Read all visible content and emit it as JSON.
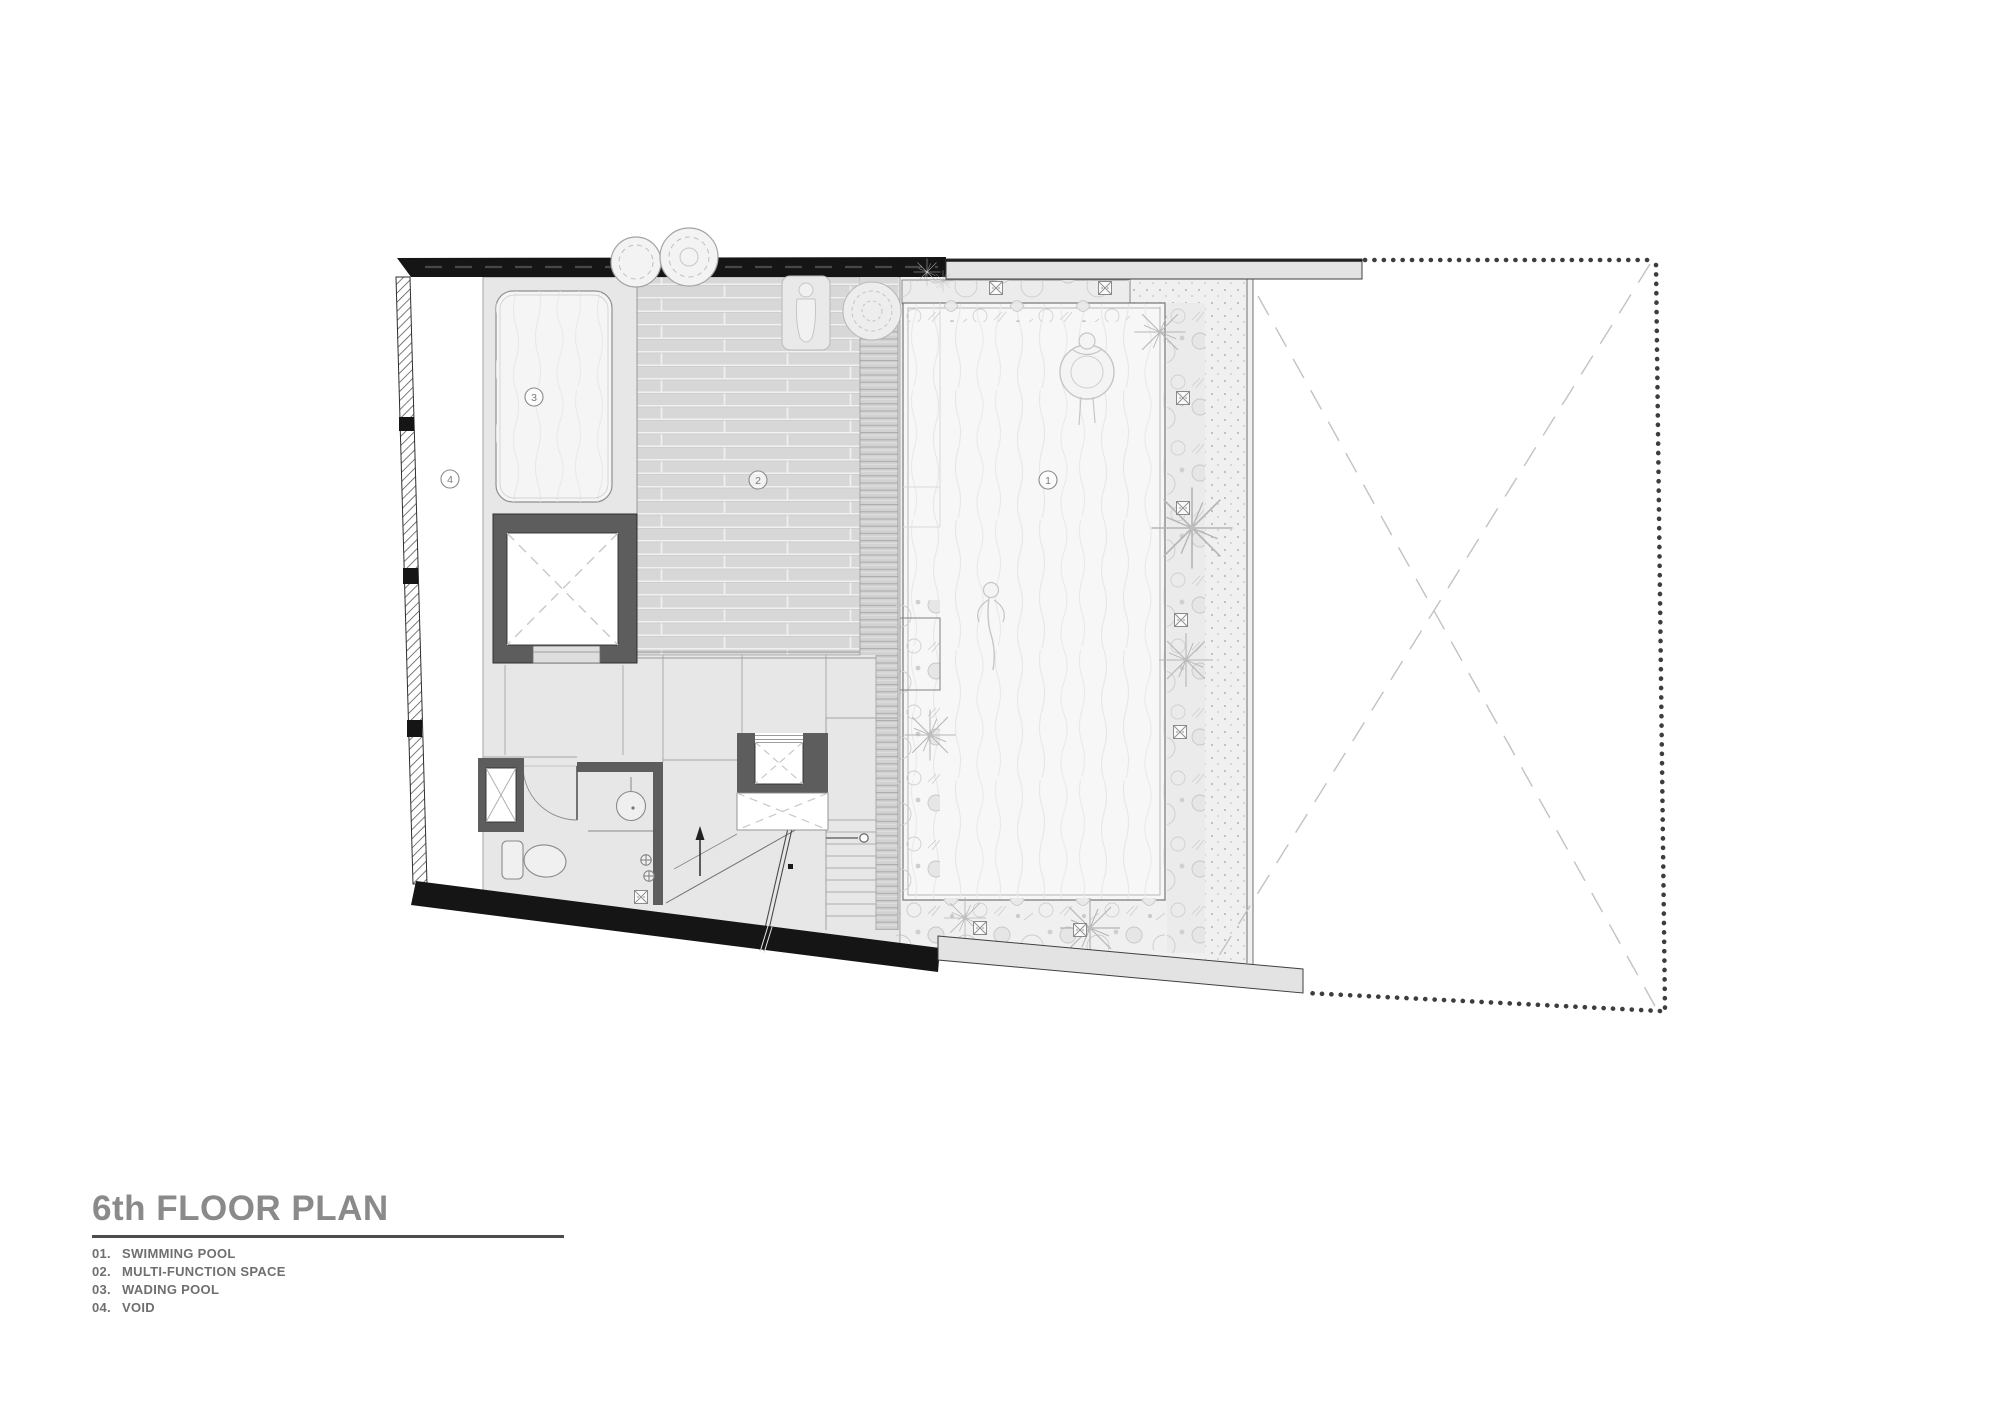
{
  "title": {
    "text": "6th FLOOR PLAN"
  },
  "legend": {
    "items": [
      {
        "number": "01.",
        "label": "SWIMMING POOL"
      },
      {
        "number": "02.",
        "label": "MULTI-FUNCTION SPACE"
      },
      {
        "number": "03.",
        "label": "WADING POOL"
      },
      {
        "number": "04.",
        "label": "VOID"
      }
    ]
  },
  "markers": {
    "swimming_pool": {
      "label": "1"
    },
    "multi_function_space": {
      "label": "2"
    },
    "wading_pool": {
      "label": "3"
    },
    "void": {
      "label": "4"
    }
  },
  "colors": {
    "wall_black": "#151515",
    "structure_gray": "#5d5d5d",
    "floor_gray": "#e7e7e7",
    "deck_gray": "#d7d7d7",
    "pool_water": "#f7f7f7",
    "boundary_dots": "#3d3d3d",
    "title_text": "#8a8a8a",
    "legend_text": "#6f6f6f"
  }
}
